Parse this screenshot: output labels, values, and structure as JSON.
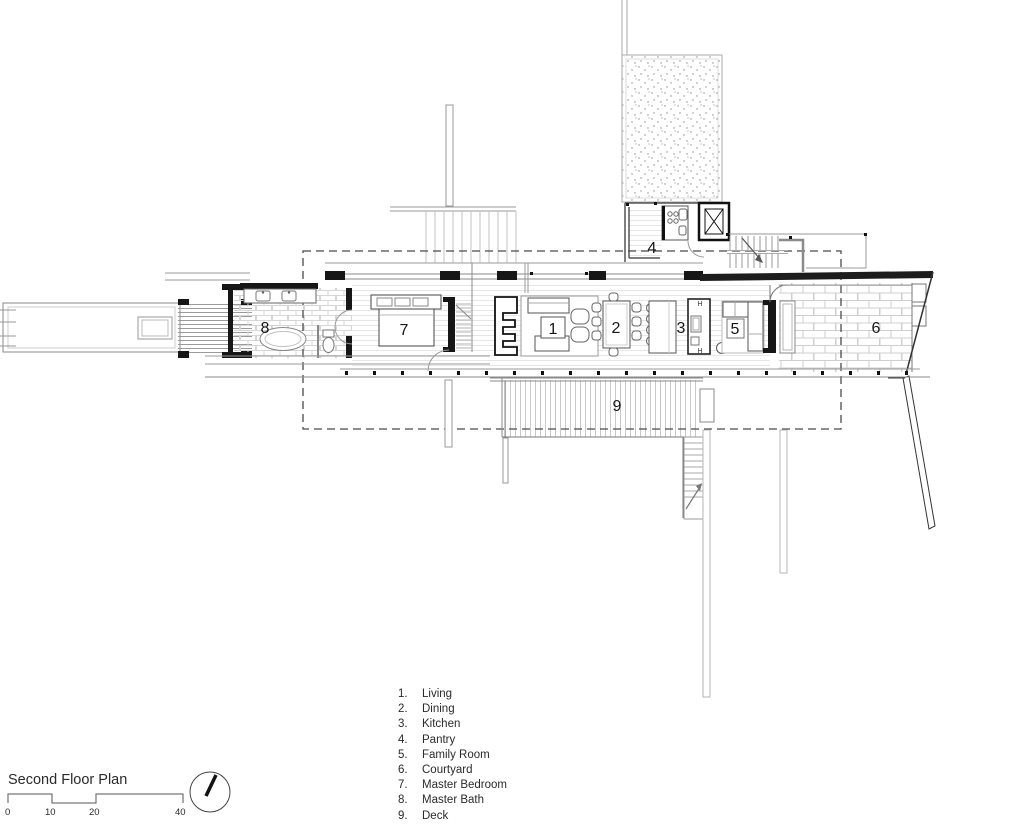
{
  "title_block": {
    "title": "Second Floor Plan",
    "scale": {
      "labels": [
        "0",
        "10",
        "20",
        "40"
      ]
    },
    "north_arrow_icon": "north-arrow"
  },
  "legend": {
    "items": [
      {
        "number": "1.",
        "label": "Living"
      },
      {
        "number": "2.",
        "label": "Dining"
      },
      {
        "number": "3.",
        "label": "Kitchen"
      },
      {
        "number": "4.",
        "label": "Pantry"
      },
      {
        "number": "5.",
        "label": "Family Room"
      },
      {
        "number": "6.",
        "label": "Courtyard"
      },
      {
        "number": "7.",
        "label": "Master Bedroom"
      },
      {
        "number": "8.",
        "label": "Master Bath"
      },
      {
        "number": "9.",
        "label": "Deck"
      }
    ]
  },
  "plan": {
    "rooms": [
      {
        "key": "living",
        "marker": "1"
      },
      {
        "key": "dining",
        "marker": "2"
      },
      {
        "key": "kitchen",
        "marker": "3"
      },
      {
        "key": "pantry",
        "marker": "4"
      },
      {
        "key": "family-room",
        "marker": "5"
      },
      {
        "key": "courtyard",
        "marker": "6"
      },
      {
        "key": "master-bedroom",
        "marker": "7"
      },
      {
        "key": "master-bath",
        "marker": "8"
      },
      {
        "key": "deck",
        "marker": "9"
      }
    ],
    "kitchen_fixture_labels": {
      "top": "H",
      "bottom": "H"
    }
  },
  "colors": {
    "ink": "#161616",
    "wall": "#333333",
    "mid_line": "#8a8a8a",
    "light_line": "#c8c8c8",
    "background": "#ffffff"
  }
}
